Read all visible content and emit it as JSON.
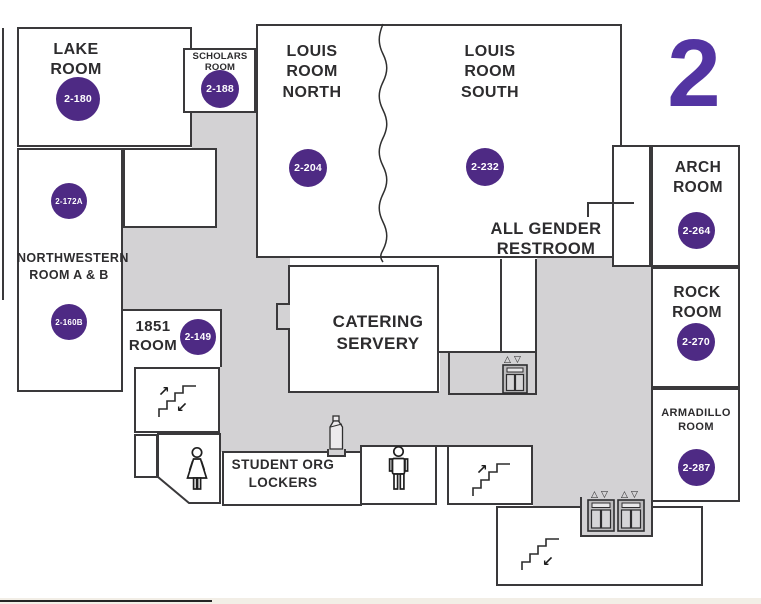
{
  "floor": {
    "number": "2"
  },
  "rooms": {
    "lake": {
      "label": "LAKE\nROOM",
      "number": "2-180"
    },
    "scholars": {
      "label": "SCHOLARS\nROOM",
      "number": "2-188"
    },
    "louis_north": {
      "label": "LOUIS\nROOM\nNORTH",
      "number": "2-204"
    },
    "louis_south": {
      "label": "LOUIS\nROOM\nSOUTH",
      "number": "2-232"
    },
    "all_gender_restroom": {
      "label": "ALL GENDER\nRESTROOM"
    },
    "arch": {
      "label": "ARCH\nROOM",
      "number": "2-264"
    },
    "rock": {
      "label": "ROCK\nROOM",
      "number": "2-270"
    },
    "armadillo": {
      "label": "ARMADILLO\nROOM",
      "number": "2-287"
    },
    "northwestern": {
      "label": "NORTHWESTERN\nROOM A & B",
      "number_a": "2-172A",
      "number_b": "2-160B"
    },
    "room_1851": {
      "label": "1851\nROOM",
      "number": "2-149"
    },
    "catering_servery": {
      "label": "CATERING\nSERVERY"
    },
    "student_org_lockers": {
      "label": "STUDENT ORG\nLOCKERS"
    }
  },
  "icons": {
    "up_arrow": "↗",
    "down_arrow": "↙",
    "elevator_up": "△",
    "elevator_down": "▽",
    "stairs": "staircase-steps",
    "womens_restroom": "woman-figure",
    "mens_restroom": "man-figure",
    "elevator": "elevator-doors",
    "bottle_station": "water-bottle"
  },
  "colors": {
    "room_number_badge": "#4e2a84",
    "floor_number": "#5334a2",
    "corridor": "#d3d2d4",
    "wall": "#3a393b"
  }
}
